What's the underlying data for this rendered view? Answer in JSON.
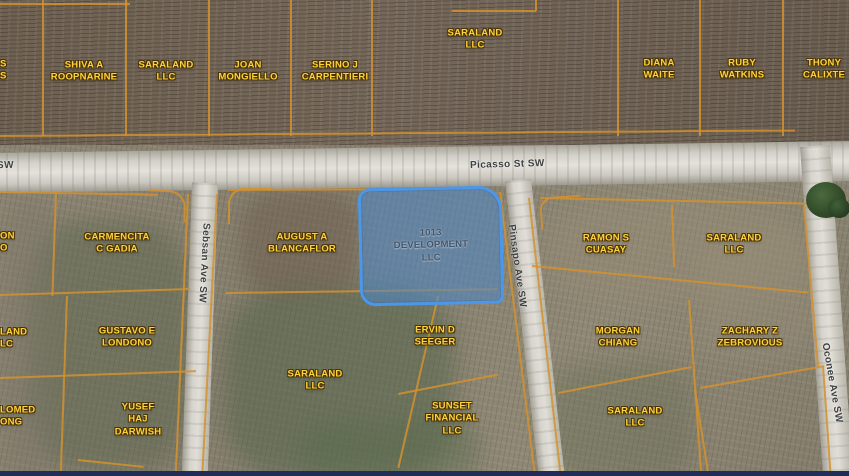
{
  "streets": {
    "picasso": "Picasso St SW",
    "left_partial": "SW",
    "sebsan": "Sebsan Ave SW",
    "pinsapo": "Pinsapo Ave SW",
    "oconee": "Oconee Ave SW"
  },
  "selected_parcel": {
    "owner": "1013 DEVELOPMENT\nLLC",
    "fill": "#4a86c8",
    "border": "#4b97ea"
  },
  "parcels": [
    {
      "owner": "S\nS"
    },
    {
      "owner": "SHIVA A\nROOPNARINE"
    },
    {
      "owner": "SARALAND\nLLC"
    },
    {
      "owner": "JOAN\nMONGIELLO"
    },
    {
      "owner": "SERINO J\nCARPENTIERI"
    },
    {
      "owner": "SARALAND\nLLC"
    },
    {
      "owner": "DIANA\nWAITE"
    },
    {
      "owner": "RUBY\nWATKINS"
    },
    {
      "owner": "THONY\nCALIXTE"
    },
    {
      "owner": "ON\nO"
    },
    {
      "owner": "CARMENCITA\nC GADIA"
    },
    {
      "owner": "LAND\nLC"
    },
    {
      "owner": "GUSTAVO E\nLONDONO"
    },
    {
      "owner": "LOMED\nONG"
    },
    {
      "owner": "YUSEF\nHAJ\nDARWISH"
    },
    {
      "owner": "AUGUST A\nBLANCAFLOR"
    },
    {
      "owner": "ERVIN D\nSEEGER"
    },
    {
      "owner": "SARALAND\nLLC"
    },
    {
      "owner": "SUNSET\nFINANCIAL\nLLC"
    },
    {
      "owner": "RAMON S\nCUASAY"
    },
    {
      "owner": "SARALAND\nLLC"
    },
    {
      "owner": "MORGAN\nCHIANG"
    },
    {
      "owner": "ZACHARY Z\nZEBROVIOUS"
    },
    {
      "owner": "SARALAND\nLLC"
    }
  ],
  "colors": {
    "parcel_boundary": "#d4922e",
    "parcel_label": "#ffd23a",
    "parcel_label_outline": "#4a3407",
    "road": "#d8d6cf",
    "bottom_bar": "#1f2e56"
  }
}
